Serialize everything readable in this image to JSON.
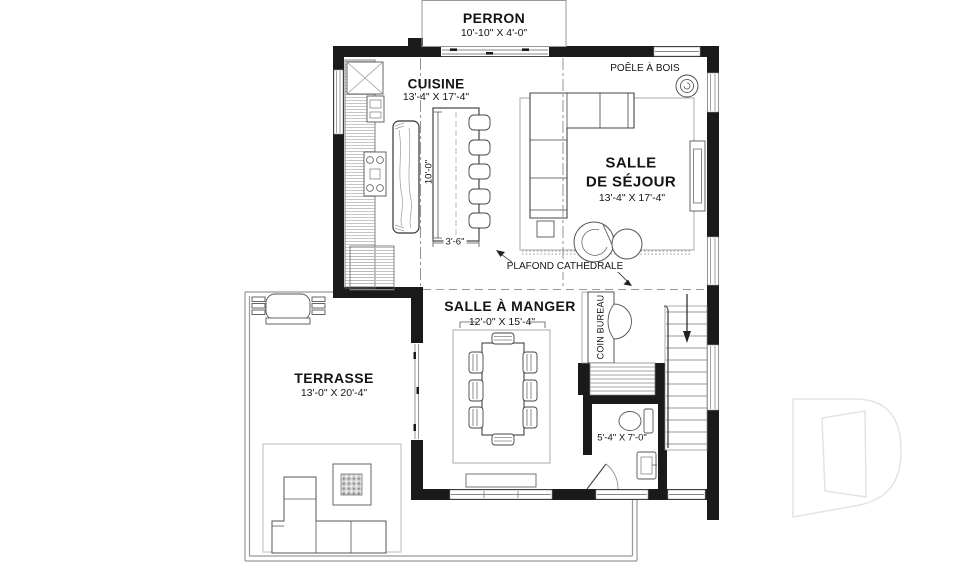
{
  "rooms": {
    "perron": {
      "name": "PERRON",
      "dims": "10'-10\" X 4'-0\""
    },
    "cuisine": {
      "name": "CUISINE",
      "dims": "13'-4\" X 17'-4\""
    },
    "salle_de_sejour": {
      "line1": "SALLE",
      "line2": "DE SÉJOUR",
      "dims": "13'-4\" X 17'-4\""
    },
    "salle_a_manger": {
      "name": "SALLE À MANGER",
      "dims": "12'-0\" X 15'-4\""
    },
    "terrasse": {
      "name": "TERRASSE",
      "dims": "13'-0\" X 20'-4\""
    },
    "salle_de_bain": {
      "dims": "5'-4\" X 7'-0\""
    },
    "coin_bureau": {
      "name": "COIN BUREAU"
    }
  },
  "annotations": {
    "poele_a_bois": "POÊLE À BOIS",
    "plafond_cathedrale": "PLAFOND CATHÉDRALE",
    "island_length": "10'-0\"",
    "island_width": "3'-6\""
  },
  "colors": {
    "wall": "#1a1a1a",
    "line": "#4a4a4a",
    "light_line": "#9a9a9a",
    "watermark": "#e3e3e3"
  }
}
